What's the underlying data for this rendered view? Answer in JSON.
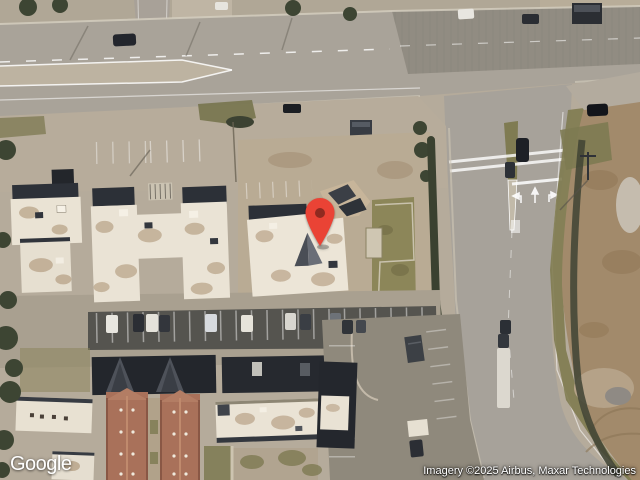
{
  "map": {
    "type": "satellite",
    "marker": {
      "color": "#EA4335",
      "dot_color": "#8F2A20"
    },
    "palette": {
      "pavement": "#a9a399",
      "dark_asphalt": "#8e8980",
      "lot": "#b7ac9b",
      "white_roof": "#eae3d5",
      "parapet": "#2c3037",
      "grass": "#7f7b52",
      "trees": "#3d4533",
      "dirt": "#a28a6b",
      "brick_roof": "#a9715a",
      "carport": "#23262c",
      "marking": "#ffffff"
    }
  },
  "branding": {
    "logo": "Google"
  },
  "attribution": {
    "text": "Imagery ©2025 Airbus, Maxar Technologies"
  }
}
